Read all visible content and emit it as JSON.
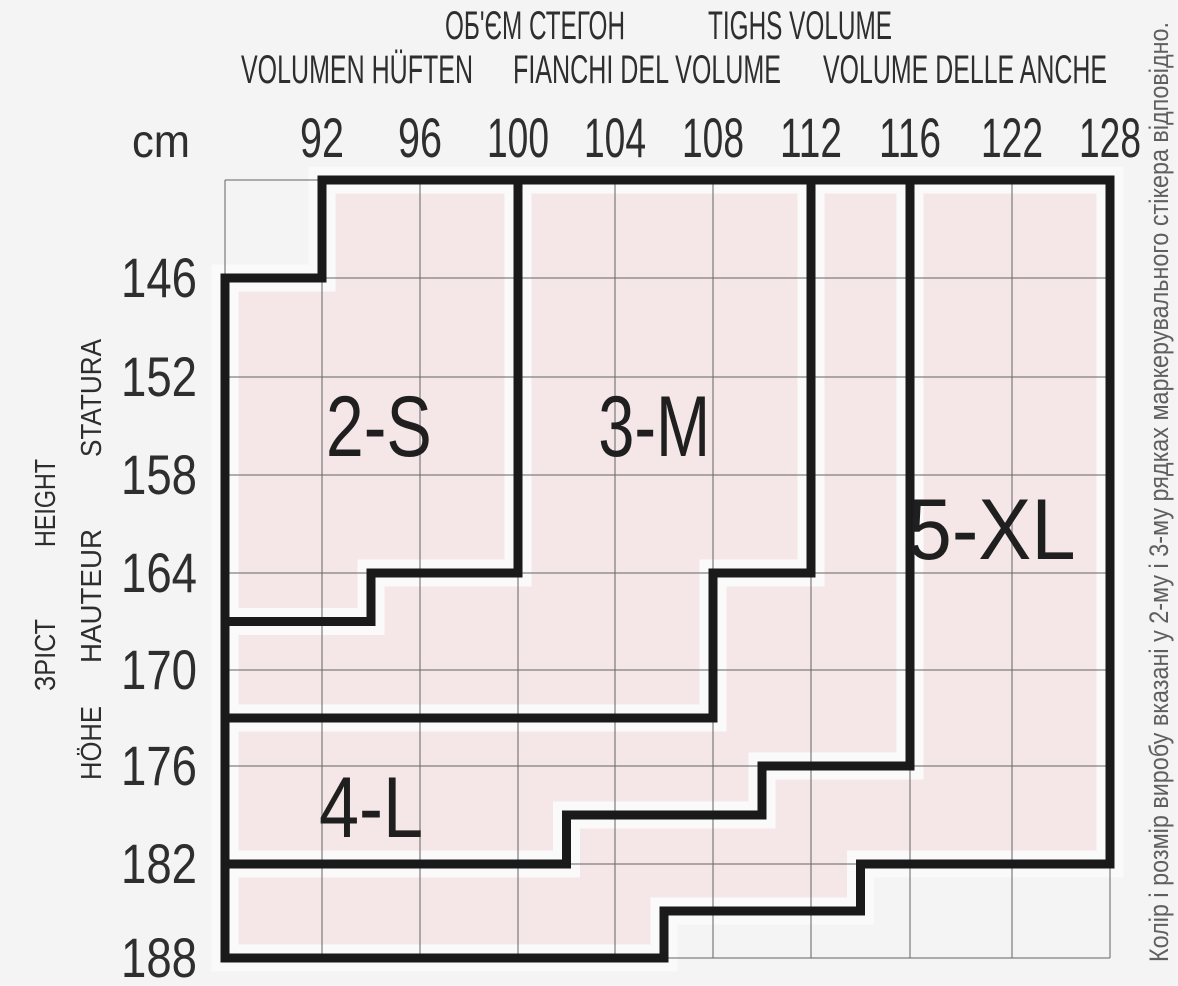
{
  "header": {
    "row1": [
      "ОБ'ЄМ СТЕГОН",
      "TIGHS VOLUME"
    ],
    "row2": [
      "VOLUMEN HÜFTEN",
      "FIANCHI DEL VOLUME",
      "VOLUME DELLE ANCHE"
    ]
  },
  "y_axis_words": [
    "ЗРІСТ",
    "HEIGHT",
    "HÖHE",
    "HAUTEUR",
    "STATURA"
  ],
  "side_note": "Колір і розмір виробу вказані у 2-му і 3-му рядках маркерувального стікера відповідно.",
  "chart_data": {
    "type": "table",
    "title": "Hosiery size chart: height (cm) vs thighs/hip volume (cm)",
    "x_unit_label": "cm",
    "x_axis_titles": [
      "ОБ'ЄМ СТЕГОН",
      "TIGHS VOLUME",
      "VOLUMEN HÜFTEN",
      "FIANCHI DEL VOLUME",
      "VOLUME DELLE ANCHE"
    ],
    "y_axis_titles": [
      "ЗРІСТ",
      "HEIGHT",
      "HÖHE",
      "HAUTEUR",
      "STATURA"
    ],
    "x_ticks": [
      "92",
      "96",
      "100",
      "104",
      "108",
      "112",
      "116",
      "122",
      "128"
    ],
    "y_ticks": [
      "146",
      "152",
      "158",
      "164",
      "170",
      "176",
      "182",
      "188"
    ],
    "grid": true,
    "regions": [
      {
        "label": "2-S",
        "polygon": [
          [
            1,
            0
          ],
          [
            3,
            0
          ],
          [
            3,
            4
          ],
          [
            1.5,
            4
          ],
          [
            1.5,
            4.5
          ],
          [
            0,
            4.5
          ],
          [
            0,
            1
          ],
          [
            1,
            1
          ]
        ],
        "label_pos": [
          1.58,
          2.5
        ]
      },
      {
        "label": "3-M",
        "polygon": [
          [
            3,
            0
          ],
          [
            6,
            0
          ],
          [
            6,
            4
          ],
          [
            5,
            4
          ],
          [
            5,
            5.5
          ],
          [
            0,
            5.5
          ],
          [
            0,
            4.5
          ],
          [
            1.5,
            4.5
          ],
          [
            1.5,
            4
          ],
          [
            3,
            4
          ]
        ],
        "label_pos": [
          4.4,
          2.5
        ]
      },
      {
        "label": "4-L",
        "polygon": [
          [
            0,
            5.5
          ],
          [
            5,
            5.5
          ],
          [
            5,
            4
          ],
          [
            6,
            4
          ],
          [
            6,
            0
          ],
          [
            7,
            0
          ],
          [
            7,
            6
          ],
          [
            5.5,
            6
          ],
          [
            5.5,
            6.5
          ],
          [
            3.5,
            6.5
          ],
          [
            3.5,
            7
          ],
          [
            0,
            7
          ]
        ],
        "label_pos": [
          1.5,
          6.42
        ]
      },
      {
        "label": "5-XL",
        "polygon": [
          [
            7,
            0
          ],
          [
            9,
            0
          ],
          [
            9,
            7
          ],
          [
            6.5,
            7
          ],
          [
            6.5,
            7.5
          ],
          [
            4.5,
            7.5
          ],
          [
            4.5,
            8
          ],
          [
            0,
            8
          ],
          [
            0,
            7
          ],
          [
            3.5,
            7
          ],
          [
            3.5,
            6.5
          ],
          [
            5.5,
            6.5
          ],
          [
            5.5,
            6
          ],
          [
            7,
            6
          ]
        ],
        "label_pos": [
          7.8,
          3.55
        ]
      }
    ],
    "colors": {
      "region_fill": "#f5e6e8",
      "region_border": "#1a1a1a",
      "grid_line": "#6f6f6f",
      "margin": "#fafafa",
      "background": "#f5f4f4",
      "text": "#2e2e2e",
      "label_text": "#1f1f1f",
      "note_text": "#5f5f5f"
    }
  }
}
